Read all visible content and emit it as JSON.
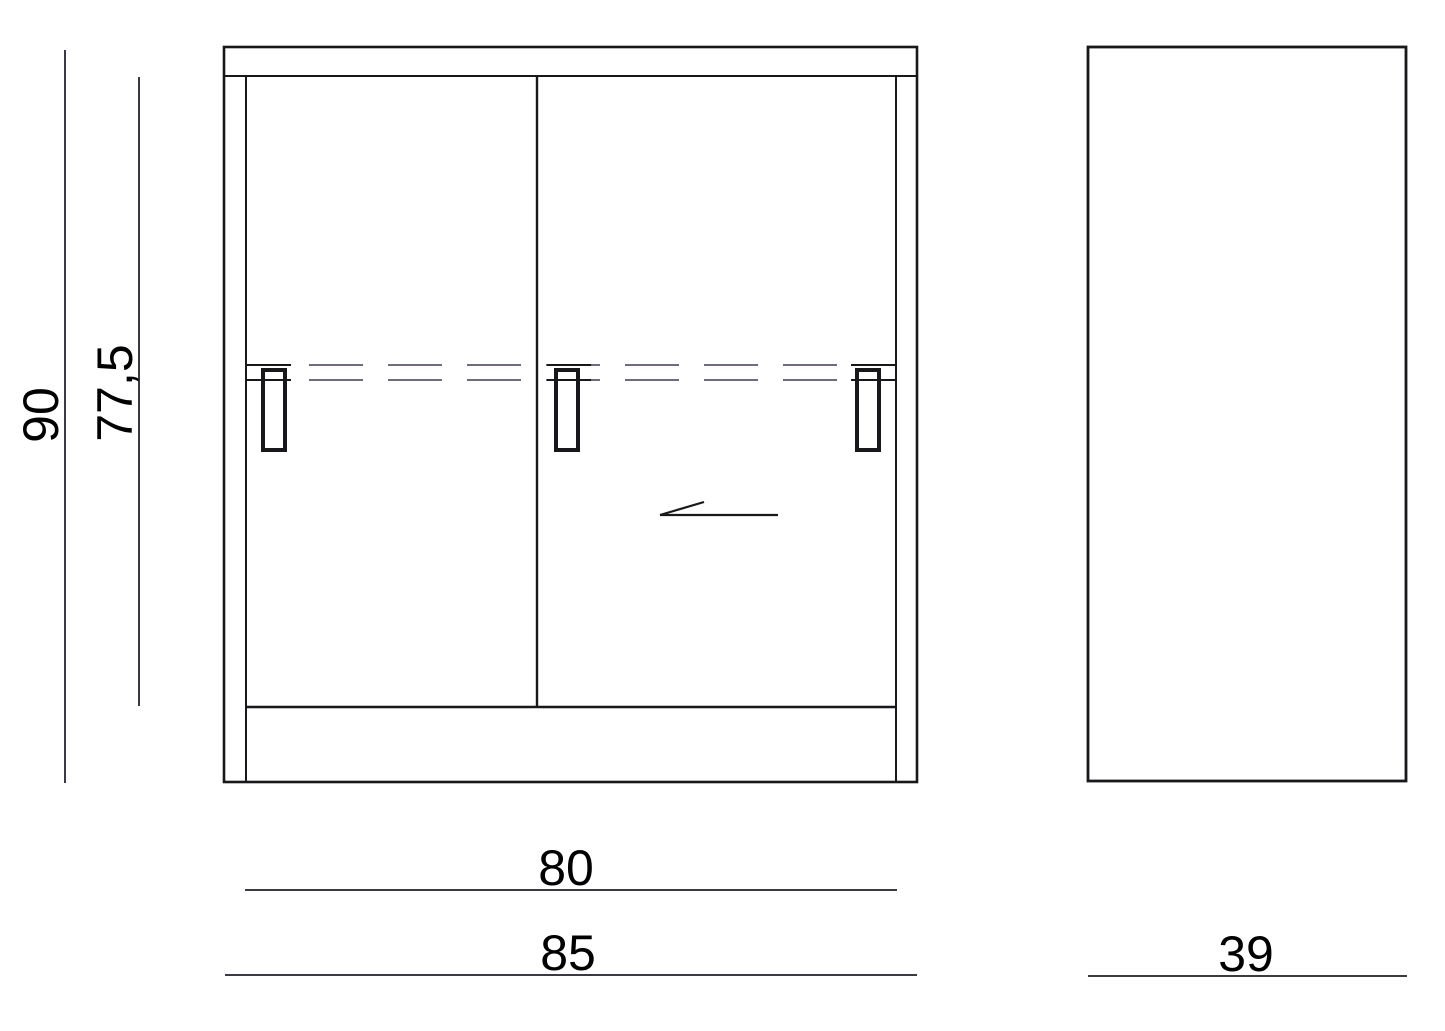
{
  "drawing": {
    "type": "furniture-technical-drawing",
    "views": [
      "front",
      "side"
    ],
    "dimensions": {
      "total_height": "90",
      "door_height": "77,5",
      "door_width": "80",
      "total_width": "85",
      "depth": "39"
    },
    "colors": {
      "outline": "#17171c",
      "dimension_line": "#3a3a44",
      "hidden_line": "#6c6c84",
      "label": "#000000",
      "background": "#ffffff"
    }
  }
}
